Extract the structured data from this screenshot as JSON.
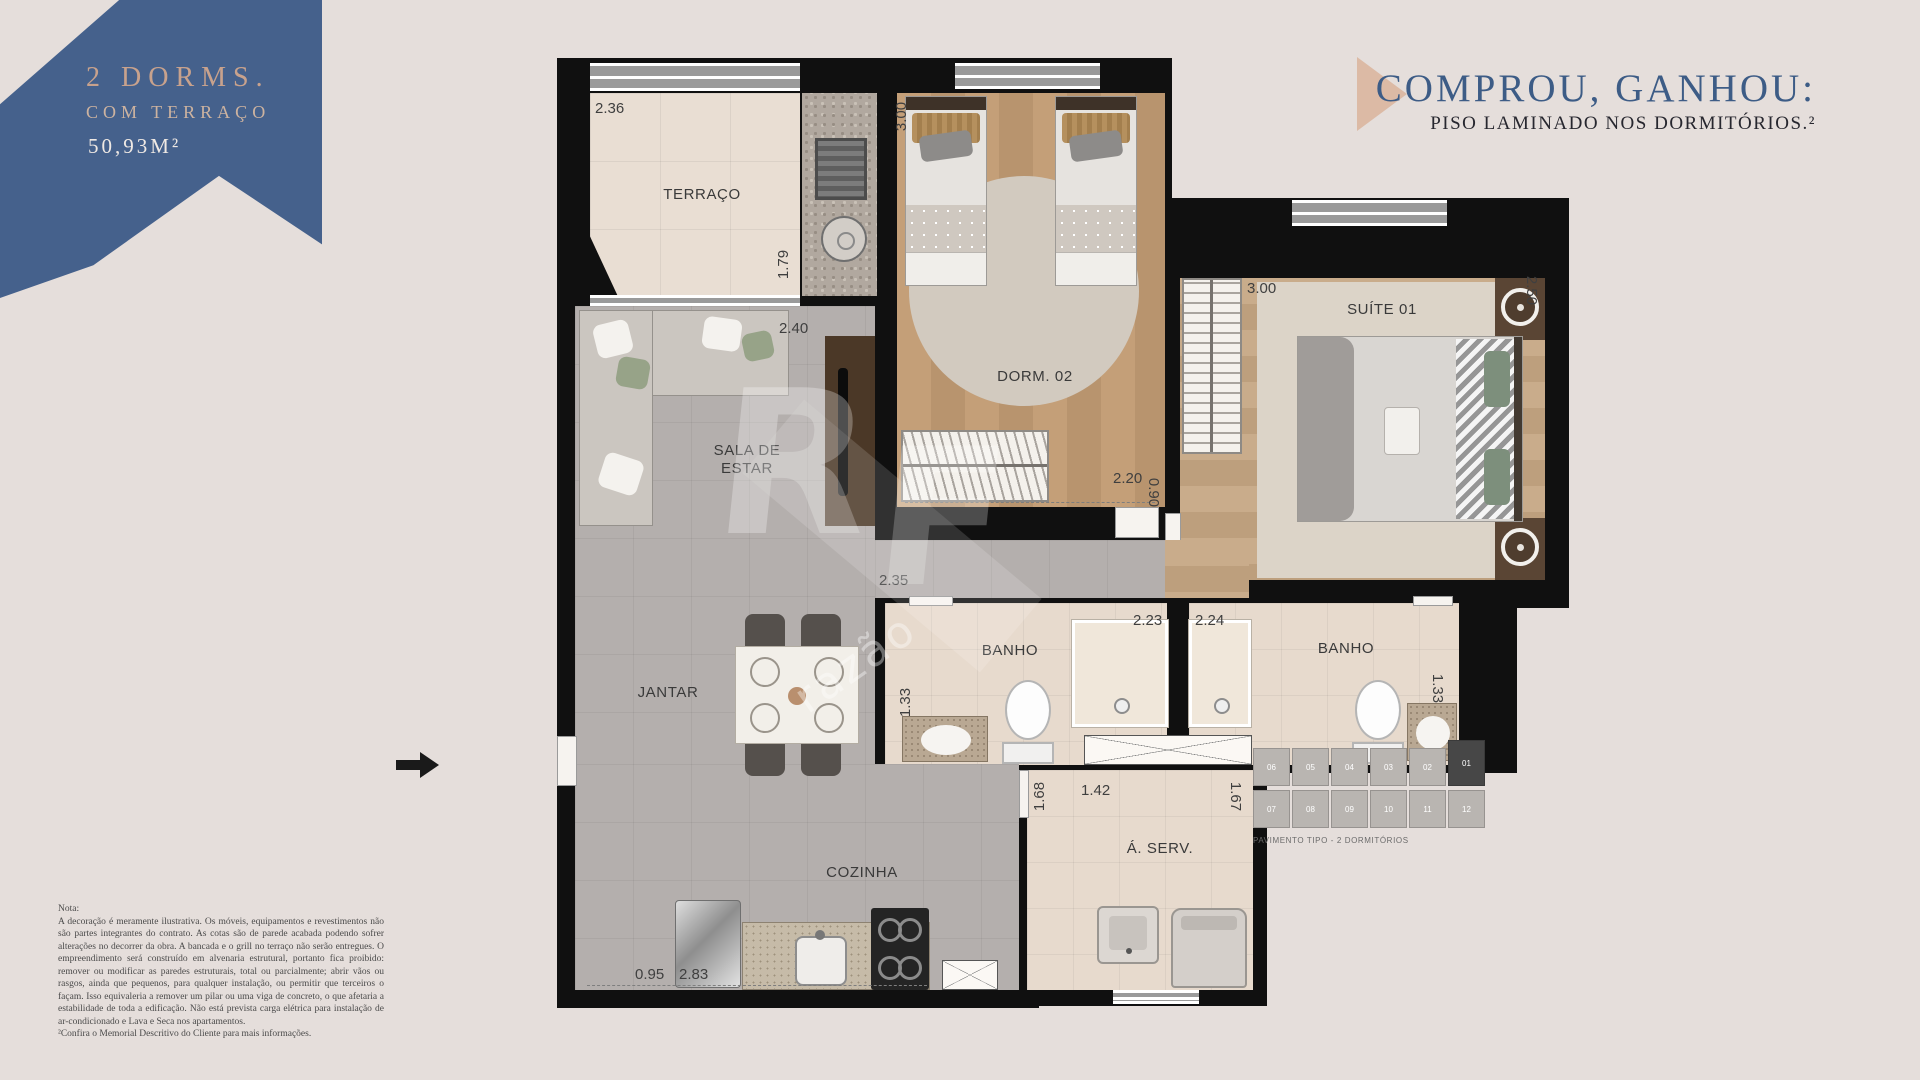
{
  "page": {
    "background": "#e5dedb"
  },
  "banner": {
    "title": "2 DORMS.",
    "subtitle": "COM TERRAÇO",
    "area": "50,93M²",
    "color": "#45618c"
  },
  "promo": {
    "title": "COMPROU, GANHOU:",
    "subtitle": "PISO LAMINADO NOS DORMITÓRIOS.²"
  },
  "floorplan": {
    "rooms": [
      {
        "id": "terraco",
        "label": "TERRAÇO"
      },
      {
        "id": "sala",
        "label": "SALA DE ESTAR"
      },
      {
        "id": "dorm02",
        "label": "DORM. 02"
      },
      {
        "id": "suite01",
        "label": "SUÍTE 01"
      },
      {
        "id": "banho1",
        "label": "BANHO"
      },
      {
        "id": "banho2",
        "label": "BANHO"
      },
      {
        "id": "jantar",
        "label": "JANTAR"
      },
      {
        "id": "cozinha",
        "label": "COZINHA"
      },
      {
        "id": "aserv",
        "label": "Á. SERV."
      }
    ],
    "dims": [
      {
        "id": "terraco-width",
        "value": "2.36"
      },
      {
        "id": "terraco-depth",
        "value": "1.79"
      },
      {
        "id": "sala-width",
        "value": "2.40"
      },
      {
        "id": "dorm02-depth",
        "value": "3.00"
      },
      {
        "id": "dorm02-width",
        "value": "2.20"
      },
      {
        "id": "hall-width",
        "value": "0.90"
      },
      {
        "id": "suite-width",
        "value": "3.00"
      },
      {
        "id": "suite-depth",
        "value": "2.50"
      },
      {
        "id": "hall-length",
        "value": "2.35"
      },
      {
        "id": "banho1-width",
        "value": "2.23"
      },
      {
        "id": "banho2-width",
        "value": "2.24"
      },
      {
        "id": "banho1-depth",
        "value": "1.33"
      },
      {
        "id": "banho2-depth",
        "value": "1.33"
      },
      {
        "id": "cozinha-depth",
        "value": "1.68"
      },
      {
        "id": "aserv-width",
        "value": "1.42"
      },
      {
        "id": "aserv-depth",
        "value": "1.67"
      },
      {
        "id": "cozinha-door",
        "value": "0.95"
      },
      {
        "id": "cozinha-width",
        "value": "2.83"
      }
    ]
  },
  "watermark": {
    "letter1": "R",
    "letter2": "F",
    "text": "razão"
  },
  "note": {
    "title": "Nota:",
    "body": "A decoração é meramente ilustrativa. Os móveis, equipamentos e revestimentos não são partes integrantes do contrato. As cotas são de parede acabada podendo sofrer alterações no decorrer da obra. A bancada e o grill no terraço não serão entregues. O empreendimento será construído em alvenaria estrutural, portanto fica proibido: remover ou modificar as paredes estruturais, total ou parcialmente; abrir vãos ou rasgos, ainda que pequenos, para qualquer instalação, ou permitir que terceiros o façam. Isso equivaleria a remover um pilar ou uma viga de concreto, o que afetaria a estabilidade de toda a edificação. Não está prevista carga elétrica para instalação de ar-condicionado e Lava e Seca nos apartamentos.",
    "footnote": "²Confira o Memorial Descritivo do Cliente para mais informações."
  },
  "key_diagram": {
    "caption": "PAVIMENTO TIPO - 2 DORMITÓRIOS",
    "top_row": [
      "06",
      "05",
      "04",
      "03",
      "02",
      "01"
    ],
    "bottom_row": [
      "07",
      "08",
      "09",
      "10",
      "11",
      "12"
    ],
    "highlighted_unit": "01"
  }
}
